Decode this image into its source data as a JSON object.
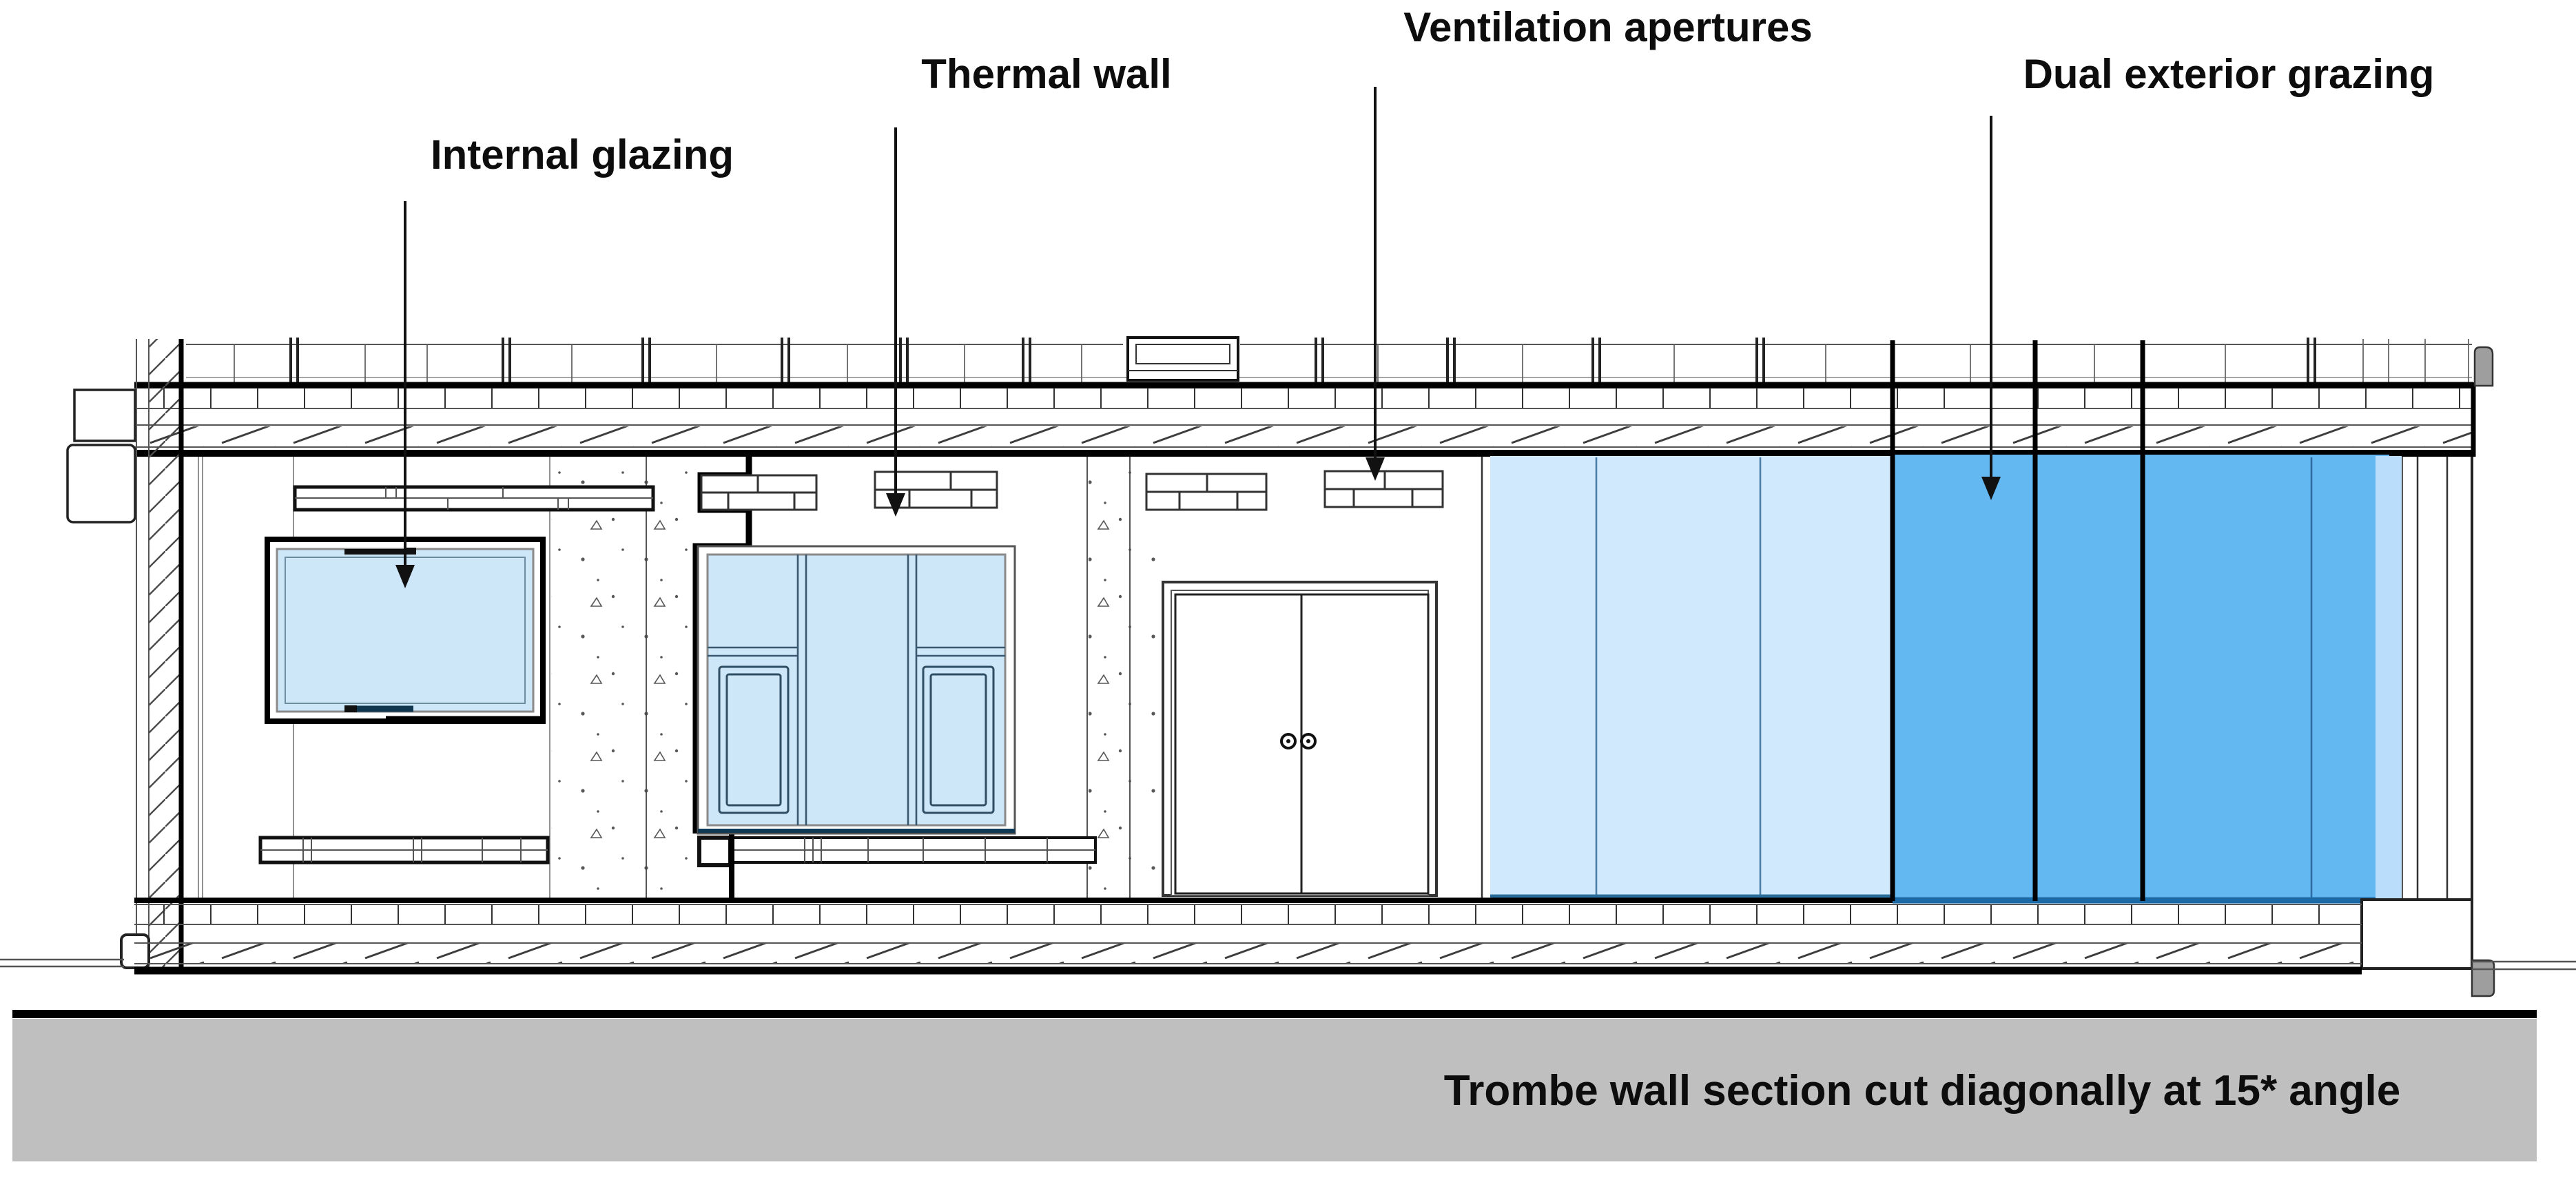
{
  "diagram": {
    "type": "architectural-section",
    "labels": {
      "internal_glazing": "Internal glazing",
      "thermal_wall": "Thermal wall",
      "ventilation_apertures": "Ventilation apertures",
      "dual_exterior_grazing": "Dual exterior grazing"
    },
    "caption": "Trombe wall section cut diagonally at 15* angle",
    "colors": {
      "glass_internal": "#cde6f8",
      "glass_curtain_light": "#d0e9fc",
      "glass_curtain_dark": "#63b8f1",
      "glass_sliver": "#b9ddfa",
      "glass_edge_dark": "#1a6aa8",
      "glass_edge_light": "#2a6d99",
      "ground_strip": "#bfbfbf",
      "cap_gray": "#9e9e9e",
      "line_black": "#000000"
    }
  }
}
